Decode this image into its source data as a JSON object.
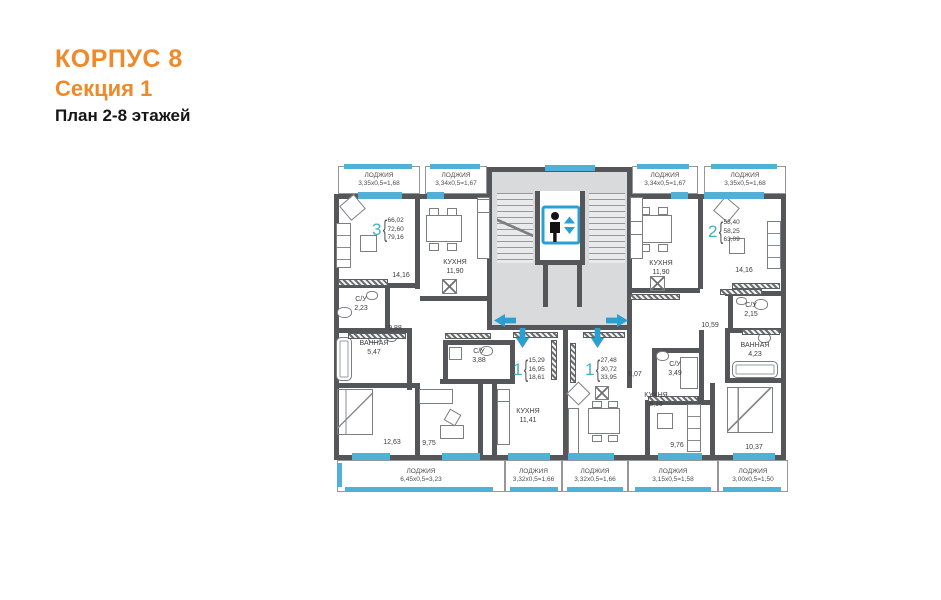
{
  "title": {
    "building": "КОРПУС 8",
    "section": "Секция 1",
    "plan": "План 2-8 этажей"
  },
  "symbols": {
    "brace": "{"
  },
  "loggias_top": [
    {
      "name": "ЛОДЖИЯ",
      "dims": "3,35х0,5=1,68"
    },
    {
      "name": "ЛОДЖИЯ",
      "dims": "3,34х0,5=1,67"
    },
    {
      "name": "ЛОДЖИЯ",
      "dims": "3,34х0,5=1,67"
    },
    {
      "name": "ЛОДЖИЯ",
      "dims": "3,35х0,5=1,68"
    }
  ],
  "loggias_bottom": [
    {
      "name": "ЛОДЖИЯ",
      "dims": "6,45х0,5=3,23"
    },
    {
      "name": "ЛОДЖИЯ",
      "dims": "3,32х0,5=1,66"
    },
    {
      "name": "ЛОДЖИЯ",
      "dims": "3,32х0,5=1,66"
    },
    {
      "name": "ЛОДЖИЯ",
      "dims": "3,15х0,5=1,58"
    },
    {
      "name": "ЛОДЖИЯ",
      "dims": "3,00х0,5=1,50"
    }
  ],
  "apartments": [
    {
      "number": "3",
      "areas": [
        "66,02",
        "72,60",
        "79,16"
      ]
    },
    {
      "number": "1",
      "areas": [
        "15,29",
        "16,95",
        "18,61"
      ]
    },
    {
      "number": "1",
      "areas": [
        "27,48",
        "30,72",
        "33,95"
      ]
    },
    {
      "number": "2",
      "areas": [
        "53,40",
        "58,25",
        "63,09"
      ]
    }
  ],
  "rooms": {
    "l_living": "14,16",
    "l_kitchen_n": "КУХНЯ",
    "l_kitchen_a": "11,90",
    "l_su_n": "С/У",
    "l_su_a": "2,23",
    "l_hall": "9,88",
    "l_bath_n": "ВАННАЯ",
    "l_bath_a": "5,47",
    "l_bed1": "12,63",
    "l_bed2": "9,75",
    "m_su_n": "С/У",
    "m_su_a": "3,88",
    "m_kitchen_n": "КУХНЯ",
    "m_kitchen_a": "11,41",
    "m2_kitchen_n": "КУХНЯ",
    "m2_kitchen_a": "8,16",
    "m2_hall": "6,07",
    "r_su2_n": "С/У",
    "r_su2_a": "3,49",
    "r_bed1": "9,76",
    "r_kitchen_n": "КУХНЯ",
    "r_kitchen_a": "11,90",
    "r_living": "14,16",
    "r_su_n": "С/У",
    "r_su_a": "2,15",
    "r_bath_n": "ВАННАЯ",
    "r_bath_a": "4,23",
    "r_hall": "10,59",
    "r_bed2": "10,37"
  },
  "colors": {
    "accent": "#ee8a2a",
    "apt_number": "#3fb3c3",
    "glazing": "#4fb0d8",
    "wall": "#55565a",
    "core_fill": "#d9dadb",
    "elevator_blue": "#2aa0d2"
  }
}
